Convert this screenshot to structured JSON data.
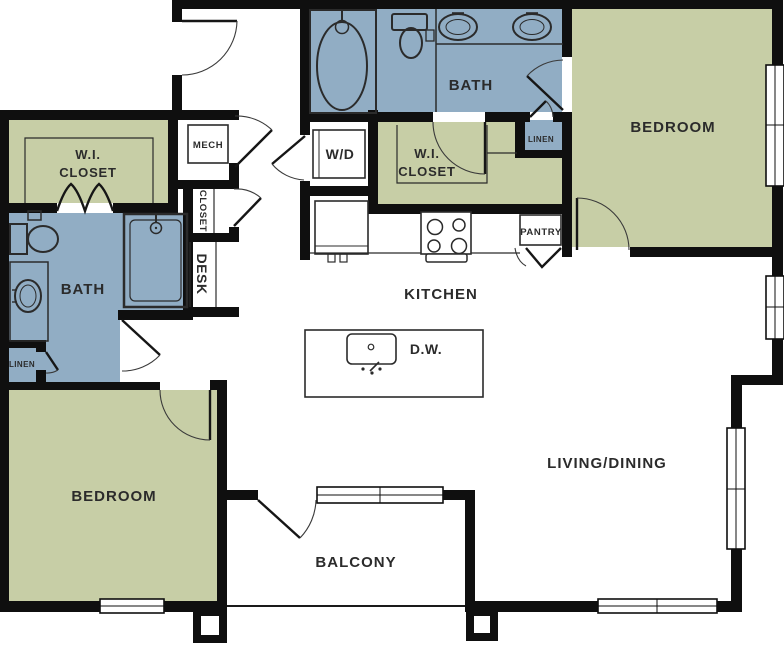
{
  "floorplan": {
    "colors": {
      "room_green": "#c7cea6",
      "room_blue": "#91adc4",
      "wall": "#0f0f0f",
      "label": "#2b2b2b"
    },
    "labels": {
      "bedroom_top_right": "BEDROOM",
      "bedroom_bottom_left": "BEDROOM",
      "bath_top": "BATH",
      "bath_left": "BATH",
      "wic_left_line1": "W.I.",
      "wic_left_line2": "CLOSET",
      "wic_mid_line1": "W.I.",
      "wic_mid_line2": "CLOSET",
      "kitchen": "KITCHEN",
      "living_dining": "LIVING/DINING",
      "balcony": "BALCONY",
      "mech": "MECH",
      "washer_dryer": "W/D",
      "dishwasher": "D.W.",
      "closet_vertical": "CLOSET",
      "desk_vertical": "DESK",
      "linen_left": "LINEN",
      "linen_top_right": "LINEN",
      "pantry": "PANTRY"
    }
  }
}
